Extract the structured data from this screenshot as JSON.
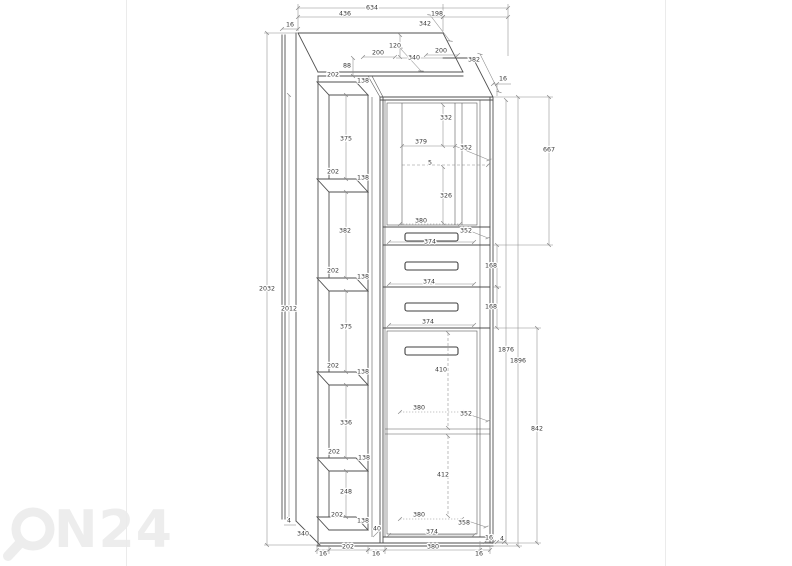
{
  "watermark": {
    "brand": "ON24",
    "text_part": "N24",
    "color": "#ededed"
  },
  "colors": {
    "background": "#ffffff",
    "structure_line": "#4f4f4f",
    "dimension_line": "#8a8a8a",
    "label_text": "#383838",
    "watermark": "#ededed",
    "page_edge": "#ebebeb"
  },
  "diagram": {
    "type": "furniture-technical-drawing",
    "overall_dimensions": {
      "width": "634",
      "height": "2032",
      "depth": "340"
    },
    "labels": [
      {
        "t": "634",
        "x": 372,
        "y": 8
      },
      {
        "t": "436",
        "x": 345,
        "y": 14
      },
      {
        "t": "198",
        "x": 437,
        "y": 14
      },
      {
        "t": "342",
        "x": 425,
        "y": 24
      },
      {
        "t": "16",
        "x": 290,
        "y": 25
      },
      {
        "t": "120",
        "x": 395,
        "y": 46
      },
      {
        "t": "200",
        "x": 378,
        "y": 53
      },
      {
        "t": "340",
        "x": 414,
        "y": 58
      },
      {
        "t": "200",
        "x": 441,
        "y": 51
      },
      {
        "t": "382",
        "x": 474,
        "y": 60
      },
      {
        "t": "88",
        "x": 347,
        "y": 66
      },
      {
        "t": "16",
        "x": 503,
        "y": 79
      },
      {
        "t": "202",
        "x": 333,
        "y": 75
      },
      {
        "t": "138",
        "x": 363,
        "y": 81
      },
      {
        "t": "375",
        "x": 346,
        "y": 139
      },
      {
        "t": "202",
        "x": 333,
        "y": 172
      },
      {
        "t": "138",
        "x": 363,
        "y": 178
      },
      {
        "t": "382",
        "x": 345,
        "y": 231
      },
      {
        "t": "202",
        "x": 333,
        "y": 271
      },
      {
        "t": "138",
        "x": 363,
        "y": 277
      },
      {
        "t": "375",
        "x": 346,
        "y": 327
      },
      {
        "t": "202",
        "x": 333,
        "y": 366
      },
      {
        "t": "138",
        "x": 363,
        "y": 372
      },
      {
        "t": "336",
        "x": 346,
        "y": 423
      },
      {
        "t": "202",
        "x": 334,
        "y": 452
      },
      {
        "t": "138",
        "x": 364,
        "y": 458
      },
      {
        "t": "248",
        "x": 346,
        "y": 492
      },
      {
        "t": "202",
        "x": 337,
        "y": 515
      },
      {
        "t": "138",
        "x": 363,
        "y": 521
      },
      {
        "t": "2032",
        "x": 267,
        "y": 289
      },
      {
        "t": "2012",
        "x": 289,
        "y": 309
      },
      {
        "t": "4",
        "x": 289,
        "y": 521
      },
      {
        "t": "340",
        "x": 303,
        "y": 534
      },
      {
        "t": "332",
        "x": 446,
        "y": 118
      },
      {
        "t": "379",
        "x": 421,
        "y": 142
      },
      {
        "t": "352",
        "x": 466,
        "y": 148
      },
      {
        "t": "5",
        "x": 430,
        "y": 163
      },
      {
        "t": "326",
        "x": 446,
        "y": 196
      },
      {
        "t": "380",
        "x": 421,
        "y": 221
      },
      {
        "t": "352",
        "x": 466,
        "y": 231
      },
      {
        "t": "374",
        "x": 430,
        "y": 242
      },
      {
        "t": "374",
        "x": 429,
        "y": 282
      },
      {
        "t": "374",
        "x": 428,
        "y": 322
      },
      {
        "t": "168",
        "x": 491,
        "y": 266
      },
      {
        "t": "168",
        "x": 491,
        "y": 307
      },
      {
        "t": "667",
        "x": 549,
        "y": 150
      },
      {
        "t": "1876",
        "x": 506,
        "y": 350
      },
      {
        "t": "1896",
        "x": 518,
        "y": 361
      },
      {
        "t": "842",
        "x": 537,
        "y": 429
      },
      {
        "t": "410",
        "x": 441,
        "y": 370
      },
      {
        "t": "380",
        "x": 419,
        "y": 408
      },
      {
        "t": "352",
        "x": 466,
        "y": 414
      },
      {
        "t": "412",
        "x": 443,
        "y": 475
      },
      {
        "t": "380",
        "x": 419,
        "y": 515
      },
      {
        "t": "358",
        "x": 464,
        "y": 523
      },
      {
        "t": "374",
        "x": 432,
        "y": 532
      },
      {
        "t": "40",
        "x": 377,
        "y": 529
      },
      {
        "t": "16",
        "x": 323,
        "y": 554
      },
      {
        "t": "202",
        "x": 348,
        "y": 547
      },
      {
        "t": "16",
        "x": 376,
        "y": 554
      },
      {
        "t": "380",
        "x": 433,
        "y": 547
      },
      {
        "t": "16",
        "x": 479,
        "y": 554
      },
      {
        "t": "16",
        "x": 489,
        "y": 538
      },
      {
        "t": "4",
        "x": 502,
        "y": 539
      }
    ]
  }
}
